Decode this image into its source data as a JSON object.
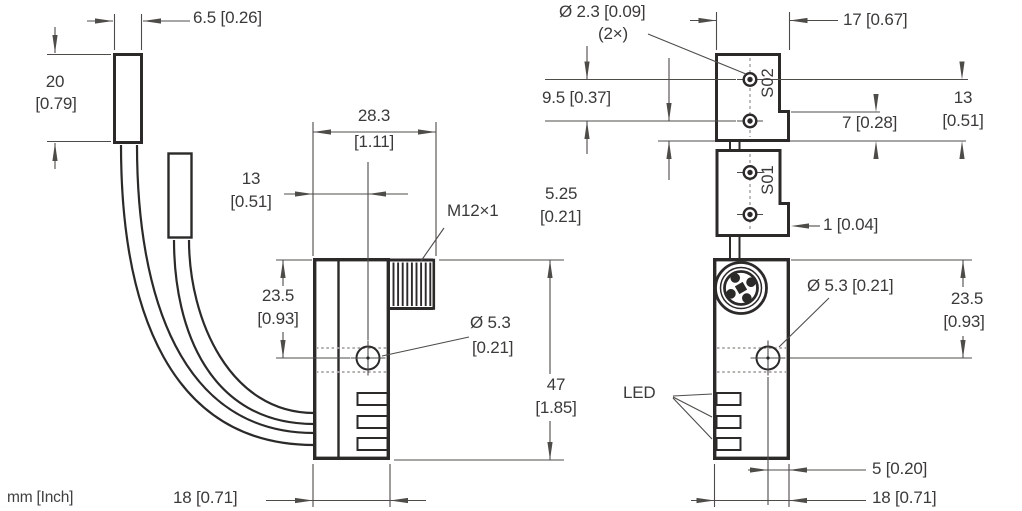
{
  "footer": {
    "units_note": "mm [Inch]"
  },
  "side_view": {
    "clamp_width": "6.5 [0.26]",
    "clamp_height_mm": "20",
    "clamp_height_in": "[0.79]",
    "overall_depth_mm": "28.3",
    "overall_depth_in": "[1.11]",
    "hole_offset_mm": "13",
    "hole_offset_in": "[0.51]",
    "thread_label": "M12×1",
    "hole_from_top_mm": "23.5",
    "hole_from_top_in": "[0.93]",
    "hole_dia_mm": "Ø 5.3",
    "hole_dia_in": "[0.21]",
    "body_height_mm": "47",
    "body_height_in": "[1.85]",
    "body_width": "18 [0.71]"
  },
  "front_view": {
    "mount_hole_dia": "Ø 2.3 [0.09]",
    "mount_hole_count": "(2×)",
    "head_width": "17 [0.67]",
    "mount_hole_spacing": "9.5 [0.37]",
    "head_height_mm": "13",
    "head_height_in": "[0.51]",
    "tab_height": "7 [0.28]",
    "hole_to_edge_mm": "5.25",
    "hole_to_edge_in": "[0.21]",
    "tab_offset": "1 [0.04]",
    "switch_label_top": "S02",
    "switch_label_bottom": "S01",
    "hole_dia": "Ø 5.3 [0.21]",
    "hole_from_top_mm": "23.5",
    "hole_from_top_in": "[0.93]",
    "led_label": "LED",
    "hole_to_side": "5 [0.20]",
    "body_width": "18 [0.71]"
  }
}
